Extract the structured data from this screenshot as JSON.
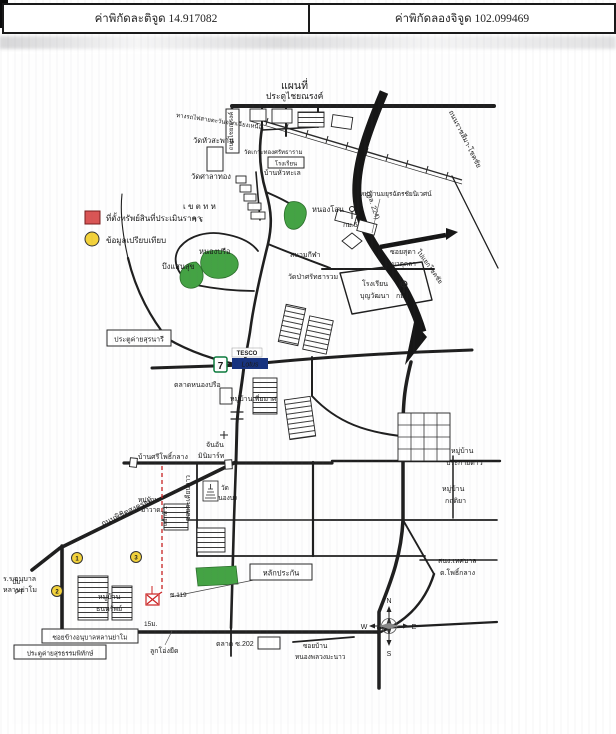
{
  "header": {
    "lat": "ค่าพิกัดละติจูด 14.917082",
    "lng": "ค่าพิกัดลองจิจูด 102.099469"
  },
  "map": {
    "title": "แผนที่",
    "legend": {
      "property": "ที่ตั้งทรัพย์สินที่ประเมินราคา",
      "comparable": "ข้อมูลเปรียบเทียบ"
    },
    "colors": {
      "green": "#44a344",
      "green_edge": "#2c6e2c",
      "highway": "#161616",
      "red": "#cc2222",
      "yellow": "#f3d23b",
      "legend_red": "#d95555",
      "lotus_blue": "#17337f",
      "tesco_red": "#d42426"
    },
    "labels": {
      "gate_chainarong": "ประตูไชยณรงค์",
      "railway": "ทางรถไฟสายตะวันออกเฉียงเหนือ",
      "wat_huasaphan": "วัดหัวสะพาน",
      "rd_chainarong": "ถนนไชยณรงค์",
      "wat_koh": "วัดเกาะทองศรัทธาราม",
      "school_box": "โรงเรียน",
      "ban_huathale": "บ้านหัวทะเล",
      "wat_salathong": "วัดศาลาทอง",
      "hw_name": "ถนนราชสีมา-โชคชัย",
      "hw_no": "(ทล. 224)",
      "moo_mayura": "หมู่บ้านมยุรฉัตรชัยนิเวศน์",
      "km5": "กม.5",
      "soi_suda": "ซอยสุดา",
      "to_chokchai": "ไปแยกโชคชัย",
      "km6": "กม.6",
      "nong_sano": "หนองโสน",
      "mil1": "เ ข ต ท ห",
      "mil2": "า ร",
      "nong_prue": "หนองปรือ",
      "bueng_saensuk": "บึงแสนสุข",
      "stadium": "สนามกีฬา",
      "wat_pa": "วัดป่าศรัทธารวม",
      "rd_matukla": "ถ.มาตุคลา",
      "school_boon1": "โรงเรียน",
      "school_boon2": "บุญวัฒนา",
      "gate_suranari": "ประตูค่ายสุรนารี",
      "market_nongprue": "ตลาดหนองปรือ",
      "moo_piamat": "หมู่บ้านเพี่ยมาศ",
      "ban_sripho": "บ้านศรีโพธิ์กลาง",
      "chanan1": "จันอัน",
      "chanan2": "มินิมาร์ท",
      "moo_prakaidao1": "หมู่บ้าน",
      "moo_prakaidao2": "ประกายดาว",
      "soi_takian": "ซอยตะเคียนยาว",
      "yaek1": "แยกที่ 1",
      "wat_nongbong1": "วัด",
      "wat_nongbong2": "หนองบง",
      "moo_mawat1": "หมู่บ้าน",
      "moo_mawat2": "มาวาด",
      "moo_krittiya1": "หมู่บ้าน",
      "moo_krittiya2": "กฤติยา",
      "tessaban1": "สนง.เทศบาล",
      "tessaban2": "ต.โพธิ์กลาง",
      "lakprakan": "หลักประกัน",
      "pump1": "ปั๊ม",
      "pump2": "PT",
      "anuban1": "ร.ร.อนุบาล",
      "anuban2": "หลานย่าโม",
      "moo_thanasap1": "หมู่บ้าน",
      "moo_thanasap2": "ธนทรัพย์",
      "soi119": "ซ.119",
      "m15": "15ม.",
      "lukong": "ลูกโอ่งยืด",
      "soi_khang": "ซอยข้างอนุบาลหลานย่าโม",
      "gate_suratham": "ประตูค่ายสุรธรรมพิทักษ์",
      "market202": "ตลาด ซ.202",
      "soi_nongpluang1": "ซอยบ้าน",
      "soi_nongpluang2": "หนองพลวงมะนาว",
      "rd_phichit": "ถนนพิชิตสงคราม"
    },
    "signs": {
      "tesco": "TESCO",
      "lotus": "Lotus",
      "seven": "7"
    },
    "markers": {
      "p1": "1",
      "p2": "2",
      "p3": "3"
    },
    "compass": {
      "n": "N",
      "e": "E",
      "s": "S",
      "w": "W"
    }
  }
}
